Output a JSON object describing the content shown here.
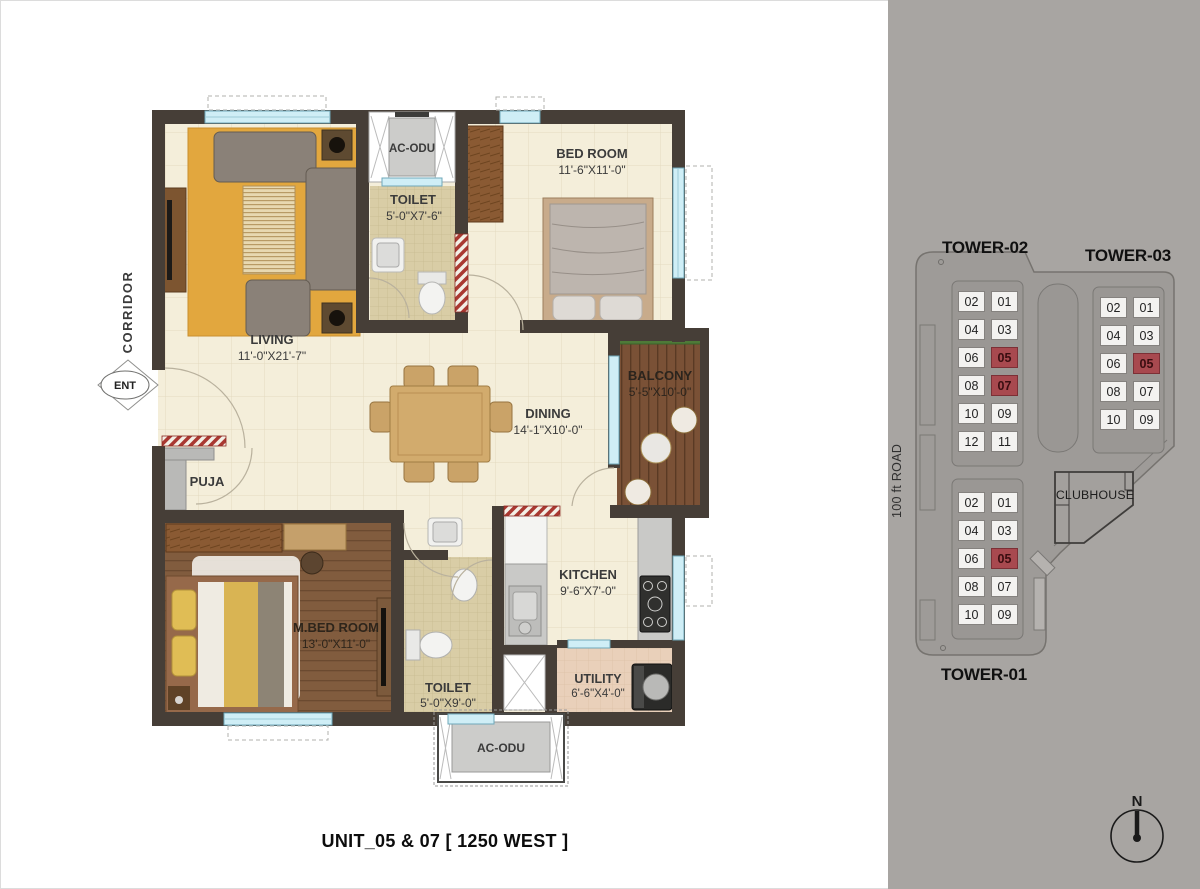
{
  "title": "UNIT_05 & 07 [ 1250 WEST ]",
  "plan": {
    "corridor": "CORRIDOR",
    "entry": "ENT",
    "ac_odu": "AC-ODU",
    "rooms": {
      "living": {
        "name": "LIVING",
        "dims": "11'-0\"X21'-7\""
      },
      "toilet_top": {
        "name": "TOILET",
        "dims": "5'-0\"X7'-6\""
      },
      "bedroom": {
        "name": "BED ROOM",
        "dims": "11'-6\"X11'-0\""
      },
      "balcony": {
        "name": "BALCONY",
        "dims": "5'-5\"X10'-0\""
      },
      "dining": {
        "name": "DINING",
        "dims": "14'-1\"X10'-0\""
      },
      "kitchen": {
        "name": "KITCHEN",
        "dims": "9'-6\"X7'-0\""
      },
      "mbedroom": {
        "name": "M.BED ROOM",
        "dims": "13'-0\"X11'-0\""
      },
      "toilet_bottom": {
        "name": "TOILET",
        "dims": "5'-0\"X9'-0\""
      },
      "utility": {
        "name": "UTILITY",
        "dims": "6'-6\"X4'-0\""
      },
      "puja": {
        "name": "PUJA"
      }
    }
  },
  "site": {
    "road_label": "100 ft ROAD",
    "clubhouse_label": "CLUBHOUSE",
    "north_label": "N",
    "colors": {
      "highlight": "#a8494f",
      "unit_bg": "#f3f2f0",
      "panel_bg": "#a8a5a2"
    },
    "towers": [
      {
        "name": "TOWER-02",
        "rows": [
          [
            "02",
            "01"
          ],
          [
            "04",
            "03"
          ],
          [
            "06",
            "05"
          ],
          [
            "08",
            "07"
          ],
          [
            "10",
            "09"
          ],
          [
            "12",
            "11"
          ]
        ],
        "highlighted": [
          "05",
          "07"
        ]
      },
      {
        "name": "TOWER-03",
        "rows": [
          [
            "02",
            "01"
          ],
          [
            "04",
            "03"
          ],
          [
            "06",
            "05"
          ],
          [
            "08",
            "07"
          ],
          [
            "10",
            "09"
          ]
        ],
        "highlighted": [
          "05"
        ]
      },
      {
        "name": "TOWER-01",
        "rows": [
          [
            "02",
            "01"
          ],
          [
            "04",
            "03"
          ],
          [
            "06",
            "05"
          ],
          [
            "08",
            "07"
          ],
          [
            "10",
            "09"
          ]
        ],
        "highlighted": [
          "05"
        ]
      }
    ]
  }
}
